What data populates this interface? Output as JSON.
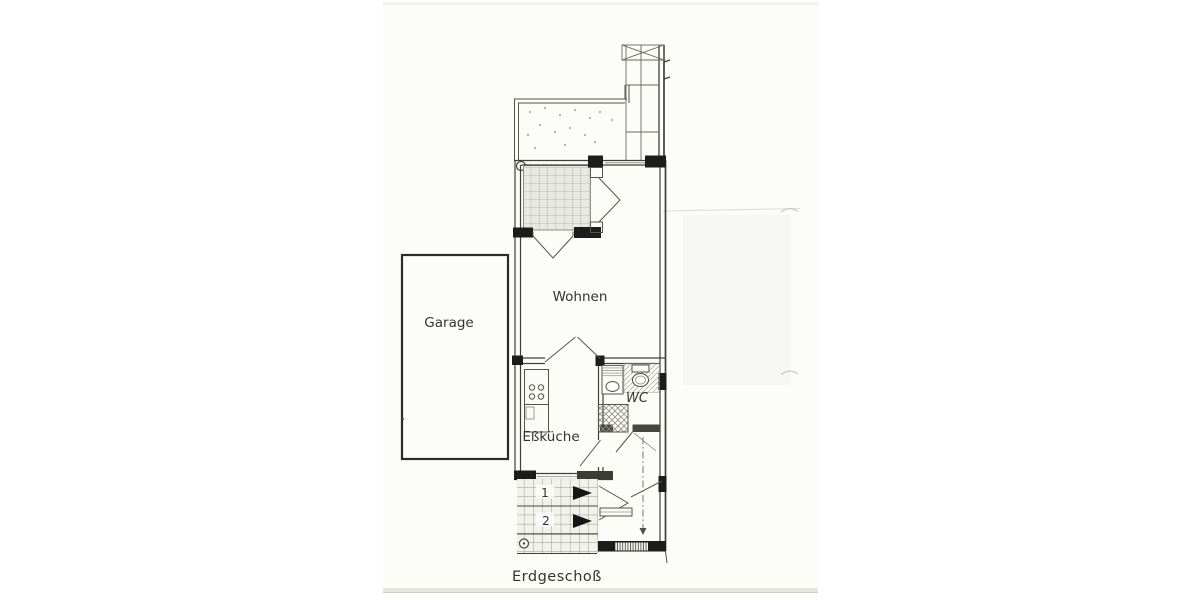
{
  "floor_plan": {
    "title": "Erdgeschoß",
    "rooms": [
      {
        "id": "garage",
        "label": "Garage"
      },
      {
        "id": "wohnen",
        "label": "Wohnen"
      },
      {
        "id": "esskueche",
        "label": "Eßküche"
      },
      {
        "id": "wc",
        "label": "WC"
      }
    ],
    "steps": [
      {
        "label": "1"
      },
      {
        "label": "2"
      }
    ],
    "symbols": [
      "stove-burners",
      "kitchen-counter",
      "washbasin",
      "toilet",
      "staircase",
      "door-swing",
      "section-line",
      "entrance-step-arrows",
      "drain-pipe",
      "glazed-bay-grid",
      "tiled-porch"
    ],
    "colors": {
      "ink": "#3f3f3b",
      "heavy_wall": "#1c1c1a",
      "grid_line": "#a9a9a1",
      "paper": "#fcfcf9",
      "bay_fill": "#e9e9e4",
      "porch_fill": "#f2f2ed"
    }
  }
}
